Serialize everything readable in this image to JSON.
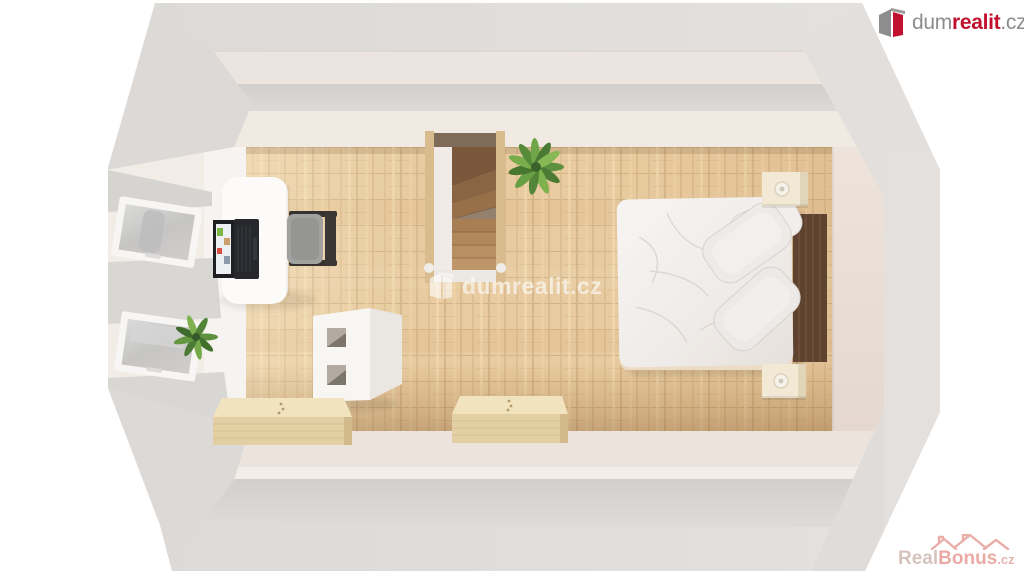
{
  "branding": {
    "logo": {
      "prefix": "dum",
      "emphasis": "realit",
      "suffix": ".cz"
    },
    "center_watermark": {
      "text": "dumrealit.cz"
    },
    "realbonus": {
      "real": "Real",
      "bonus": "Bonus",
      "suffix": ".cz"
    }
  },
  "colors": {
    "brand_red": "#c0122f",
    "logo_gray": "#8d8d8d",
    "watermark_white": "rgba(255,255,255,0.62)",
    "realbonus_pink": "#e6958e",
    "realbonus_gray": "#ccb5ad",
    "wall_gray": "#dfdcd9",
    "wall_warm_white": "#f0e9e3",
    "floor_wood": "#e8cba0",
    "stair_wood": "#8a6543",
    "headboard_wood": "#5f4331",
    "chest_wood": "#ecdcb2"
  },
  "icons": [
    "dumrealit-building-icon",
    "house-roofs-icon"
  ],
  "scene": {
    "items": [
      "wooden-floor",
      "staircase",
      "double-bed",
      "pillows",
      "headboard",
      "nightstands",
      "desk",
      "laptop",
      "office-chair",
      "roof-windows",
      "plants",
      "storage-cabinet",
      "wooden-chests",
      "attic-walls"
    ]
  }
}
